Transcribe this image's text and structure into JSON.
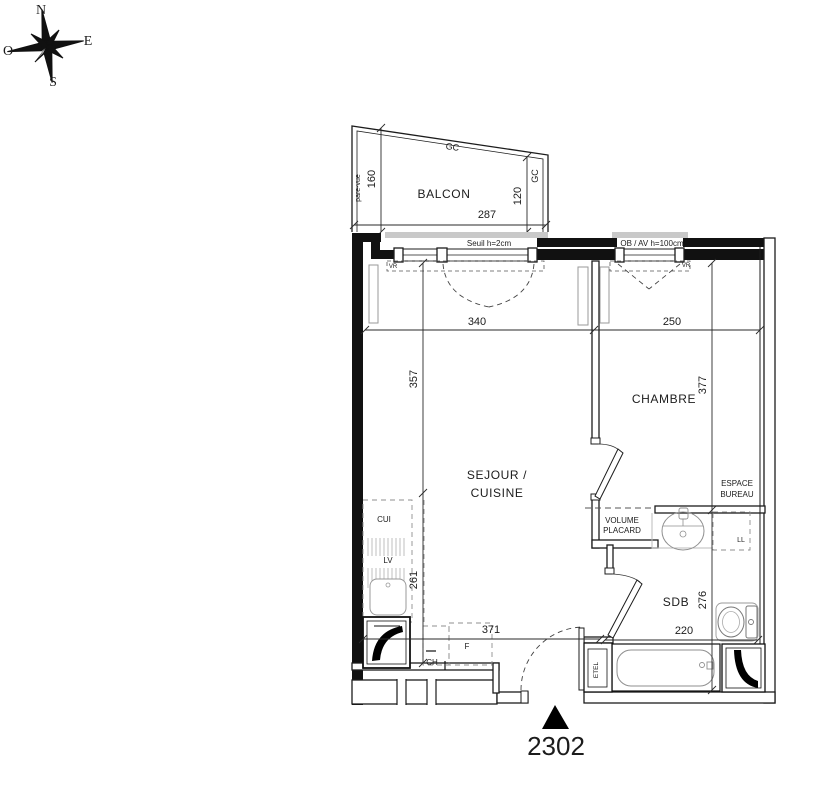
{
  "unit": {
    "number": "2302"
  },
  "compass": {
    "n": "N",
    "e": "E",
    "s": "S",
    "o": "O"
  },
  "balcony": {
    "label": "BALCON",
    "privacy_screen": "pare-vue",
    "gc_top": "GC",
    "gc_right": "GC",
    "dim_left": "160",
    "dim_right": "120",
    "dim_width": "287"
  },
  "rooms": {
    "living": {
      "line1": "SEJOUR /",
      "line2": "CUISINE"
    },
    "bedroom": {
      "label": "CHAMBRE"
    },
    "bathroom": {
      "label": "SDB"
    },
    "closet": {
      "line1": "VOLUME",
      "line2": "PLACARD"
    },
    "desk_area": {
      "line1": "ESPACE",
      "line2": "BUREAU"
    }
  },
  "dimensions": {
    "living_width": "340",
    "bedroom_width": "250",
    "living_height_upper": "357",
    "living_height_lower": "261",
    "bedroom_height": "377",
    "bathroom_height": "276",
    "hall_width": "371",
    "bathroom_width": "220"
  },
  "annotations": {
    "threshold": "Seuil h=2cm",
    "window_note": "OB / AV h=100cm",
    "vr_left": "VR",
    "vr_right": "VR"
  },
  "fixtures": {
    "kitchen": "CUI",
    "dishwasher": "LV",
    "fridge": "F",
    "boiler": "CH",
    "washing_machine": "LL",
    "technical_closet": "ETEL"
  },
  "colors": {
    "line": "#1c1c1c",
    "wall_fill": "#111111",
    "fixture_line": "#8f8f8f",
    "sill": "#c9c9c9",
    "background": "#ffffff"
  }
}
